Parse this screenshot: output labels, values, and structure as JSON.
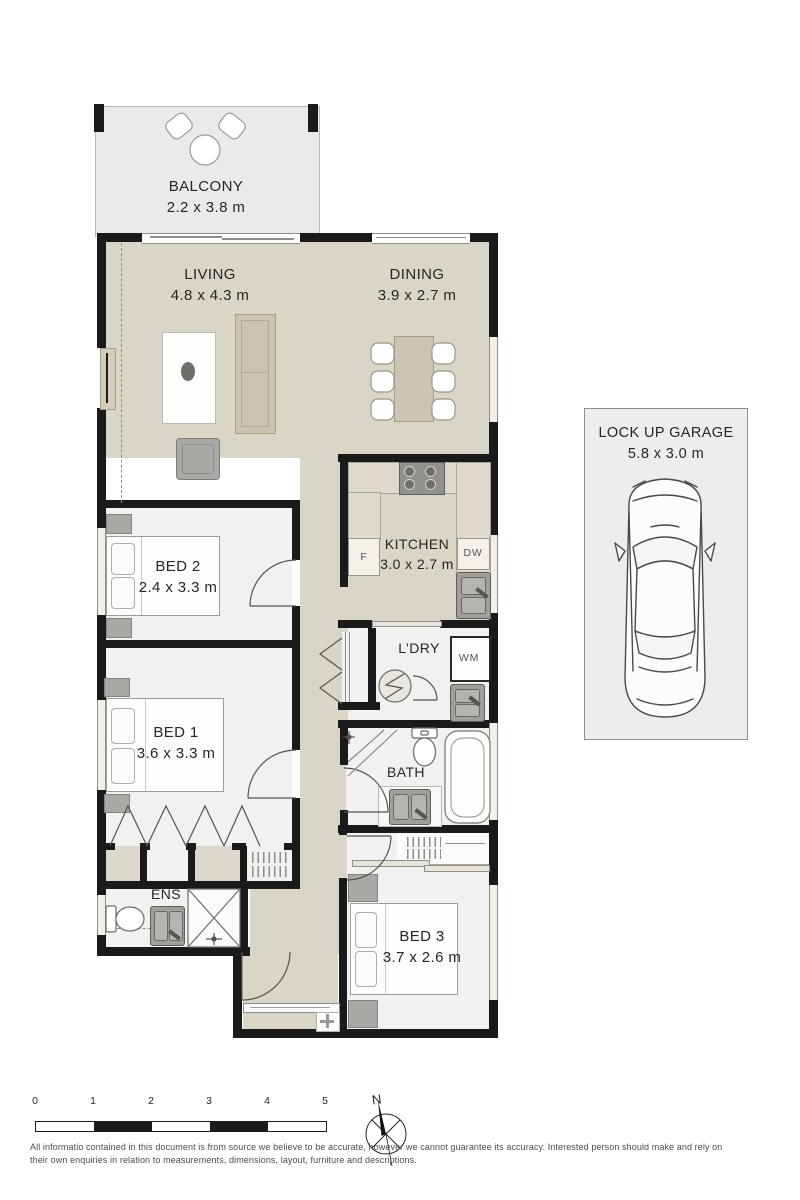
{
  "plan": {
    "balcony": {
      "name": "BALCONY",
      "dims": "2.2 x 3.8 m"
    },
    "living": {
      "name": "LIVING",
      "dims": "4.8 x 4.3 m"
    },
    "dining": {
      "name": "DINING",
      "dims": "3.9 x 2.7 m"
    },
    "kitchen": {
      "name": "KITCHEN",
      "dims": "3.0 x 2.7 m"
    },
    "bed1": {
      "name": "BED 1",
      "dims": "3.6 x 3.3 m"
    },
    "bed2": {
      "name": "BED 2",
      "dims": "2.4 x 3.3 m"
    },
    "bed3": {
      "name": "BED 3",
      "dims": "3.7 x 2.6 m"
    },
    "laundry": {
      "name": "L’DRY"
    },
    "bath": {
      "name": "BATH"
    },
    "ensuite": {
      "name": "ENS"
    },
    "garage": {
      "name": "LOCK UP GARAGE",
      "dims": "5.8 x 3.0 m"
    },
    "appliances": {
      "fridge": "F",
      "dishwasher": "DW",
      "washing_machine": "WM"
    }
  },
  "scale_bar": {
    "ticks": [
      "0",
      "1",
      "2",
      "3",
      "4",
      "5"
    ]
  },
  "compass": {
    "north": "N"
  },
  "disclaimer": "All informatio contained in this document is from source we believe to be accurate, however we cannot guarantee its accuracy. Interested person should make and rely on their own enquiries in relation to measurements, dimensions, layout, furniture and descriptions.",
  "colors": {
    "wall": "#1a1a1a",
    "floor_main": "#d9d5c7",
    "floor_rooms": "#f1f1ef",
    "balcony": "#e9ebe9",
    "furniture_beige": "#ccc3b0",
    "fixture_gray": "#a19f9a"
  }
}
